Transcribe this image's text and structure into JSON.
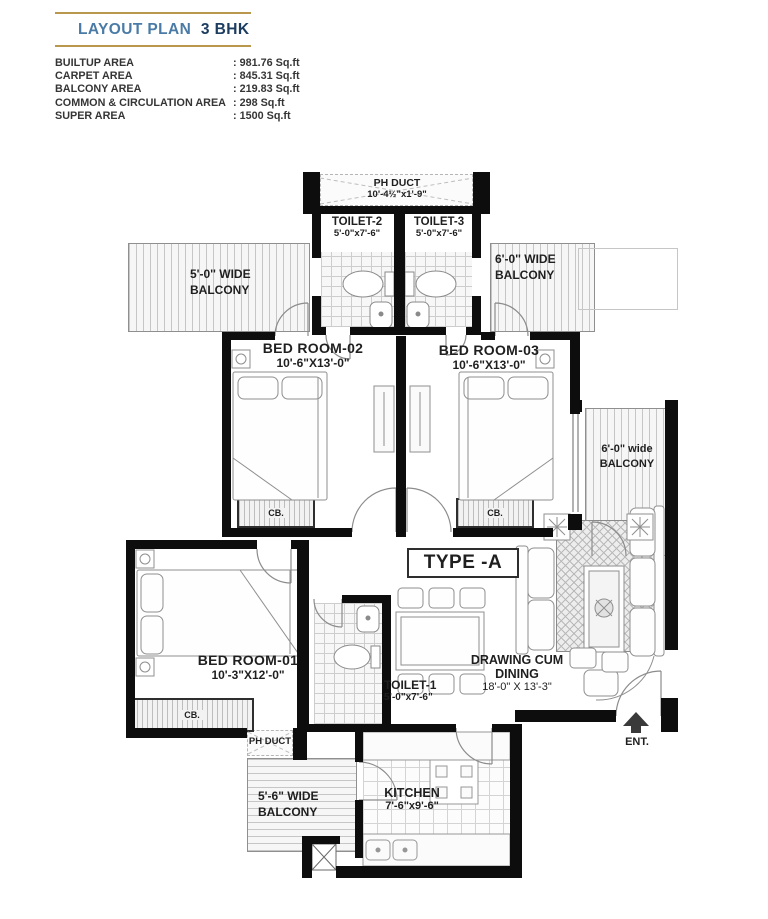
{
  "header": {
    "title": "LAYOUT PLAN",
    "bhk": "3 BHK"
  },
  "area_table": {
    "rows": [
      {
        "label": "BUILTUP AREA",
        "value": ": 981.76 Sq.ft"
      },
      {
        "label": "CARPET AREA",
        "value": ": 845.31 Sq.ft"
      },
      {
        "label": "BALCONY AREA",
        "value": ": 219.83 Sq.ft"
      },
      {
        "label": "COMMON & CIRCULATION AREA",
        "value": ": 298 Sq.ft"
      },
      {
        "label": "SUPER AREA",
        "value": ": 1500 Sq.ft"
      }
    ]
  },
  "plan": {
    "type_label": "TYPE -A",
    "ent_label": "ENT.",
    "cb_label": "CB.",
    "ph_duct_top": {
      "name": "PH DUCT",
      "dims": "10'-4½\"x1'-9\""
    },
    "ph_duct_bottom": {
      "name": "PH DUCT"
    },
    "toilet2": {
      "name": "TOILET-2",
      "dims": "5'-0\"x7'-6\""
    },
    "toilet3": {
      "name": "TOILET-3",
      "dims": "5'-0\"x7'-6\""
    },
    "toilet1": {
      "name": "TOILET-1",
      "dims": "5'-0\"x7'-6\""
    },
    "bedroom2": {
      "name": "BED ROOM-02",
      "dims": "10'-6\"X13'-0\""
    },
    "bedroom3": {
      "name": "BED ROOM-03",
      "dims": "10'-6\"X13'-0\""
    },
    "bedroom1": {
      "name": "BED ROOM-01",
      "dims": "10'-3\"X12'-0\""
    },
    "kitchen": {
      "name": "KITCHEN",
      "dims": "7'-6\"x9'-6\""
    },
    "drawing_dining": {
      "name1": "DRAWING CUM",
      "name2": "DINING",
      "dims": "18'-0\" X 13'-3\""
    },
    "balcony_top_left": {
      "name1": "5'-0'' WIDE",
      "name2": "BALCONY"
    },
    "balcony_top_right": {
      "name1": "6'-0'' WIDE",
      "name2": "BALCONY"
    },
    "balcony_mid_right": {
      "name1": "6'-0\" wide",
      "name2": "BALCONY"
    },
    "balcony_bottom": {
      "name1": "5'-6\" WIDE",
      "name2": "BALCONY"
    }
  }
}
